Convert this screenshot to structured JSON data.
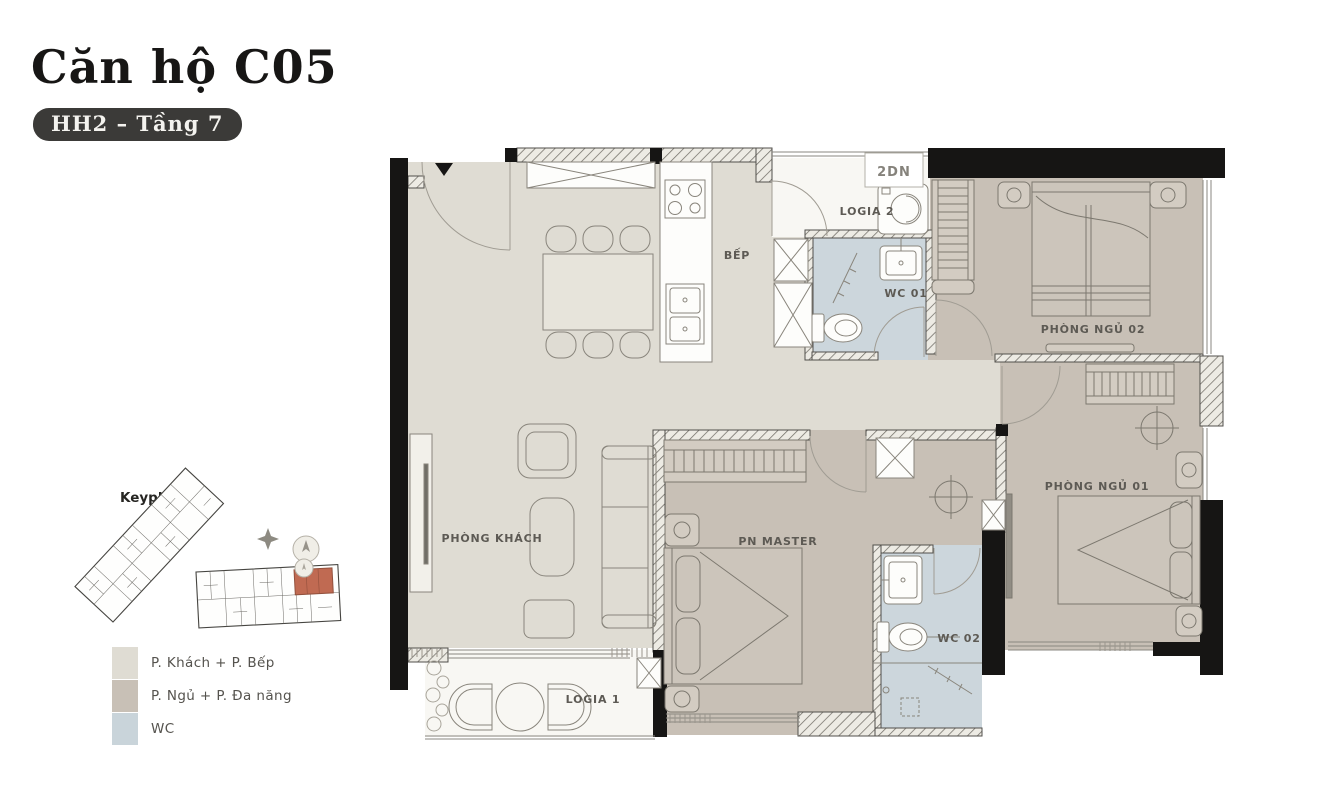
{
  "header": {
    "title": "Căn hộ C05",
    "badge": "HH2 – Tầng 7"
  },
  "keyplan": {
    "title": "Keyplan",
    "highlight_color": "#c06a52"
  },
  "legend": {
    "items": [
      {
        "label": "P. Khách + P. Bếp",
        "color": "#dfdcd3"
      },
      {
        "label": "P. Ngủ + P. Đa năng",
        "color": "#c8c0b6"
      },
      {
        "label": "WC",
        "color": "#c9d4da"
      }
    ]
  },
  "plan": {
    "labels": {
      "kitchen": "BẾP",
      "logia2": "LOGIA 2",
      "ac_unit": "2DN",
      "wc1": "WC 01",
      "bedroom2": "PHÒNG NGỦ 02",
      "living": "PHÒNG KHÁCH",
      "master": "PN MASTER",
      "wc2": "WC 02",
      "bedroom1": "PHÒNG NGỦ 01",
      "logia1": "LOGIA 1"
    },
    "colors": {
      "living_kitchen": "#dfdcd3",
      "bedroom": "#c8c0b6",
      "wc": "#ccd6dc",
      "logia": "#f8f7f3",
      "wall": "#161514"
    }
  }
}
